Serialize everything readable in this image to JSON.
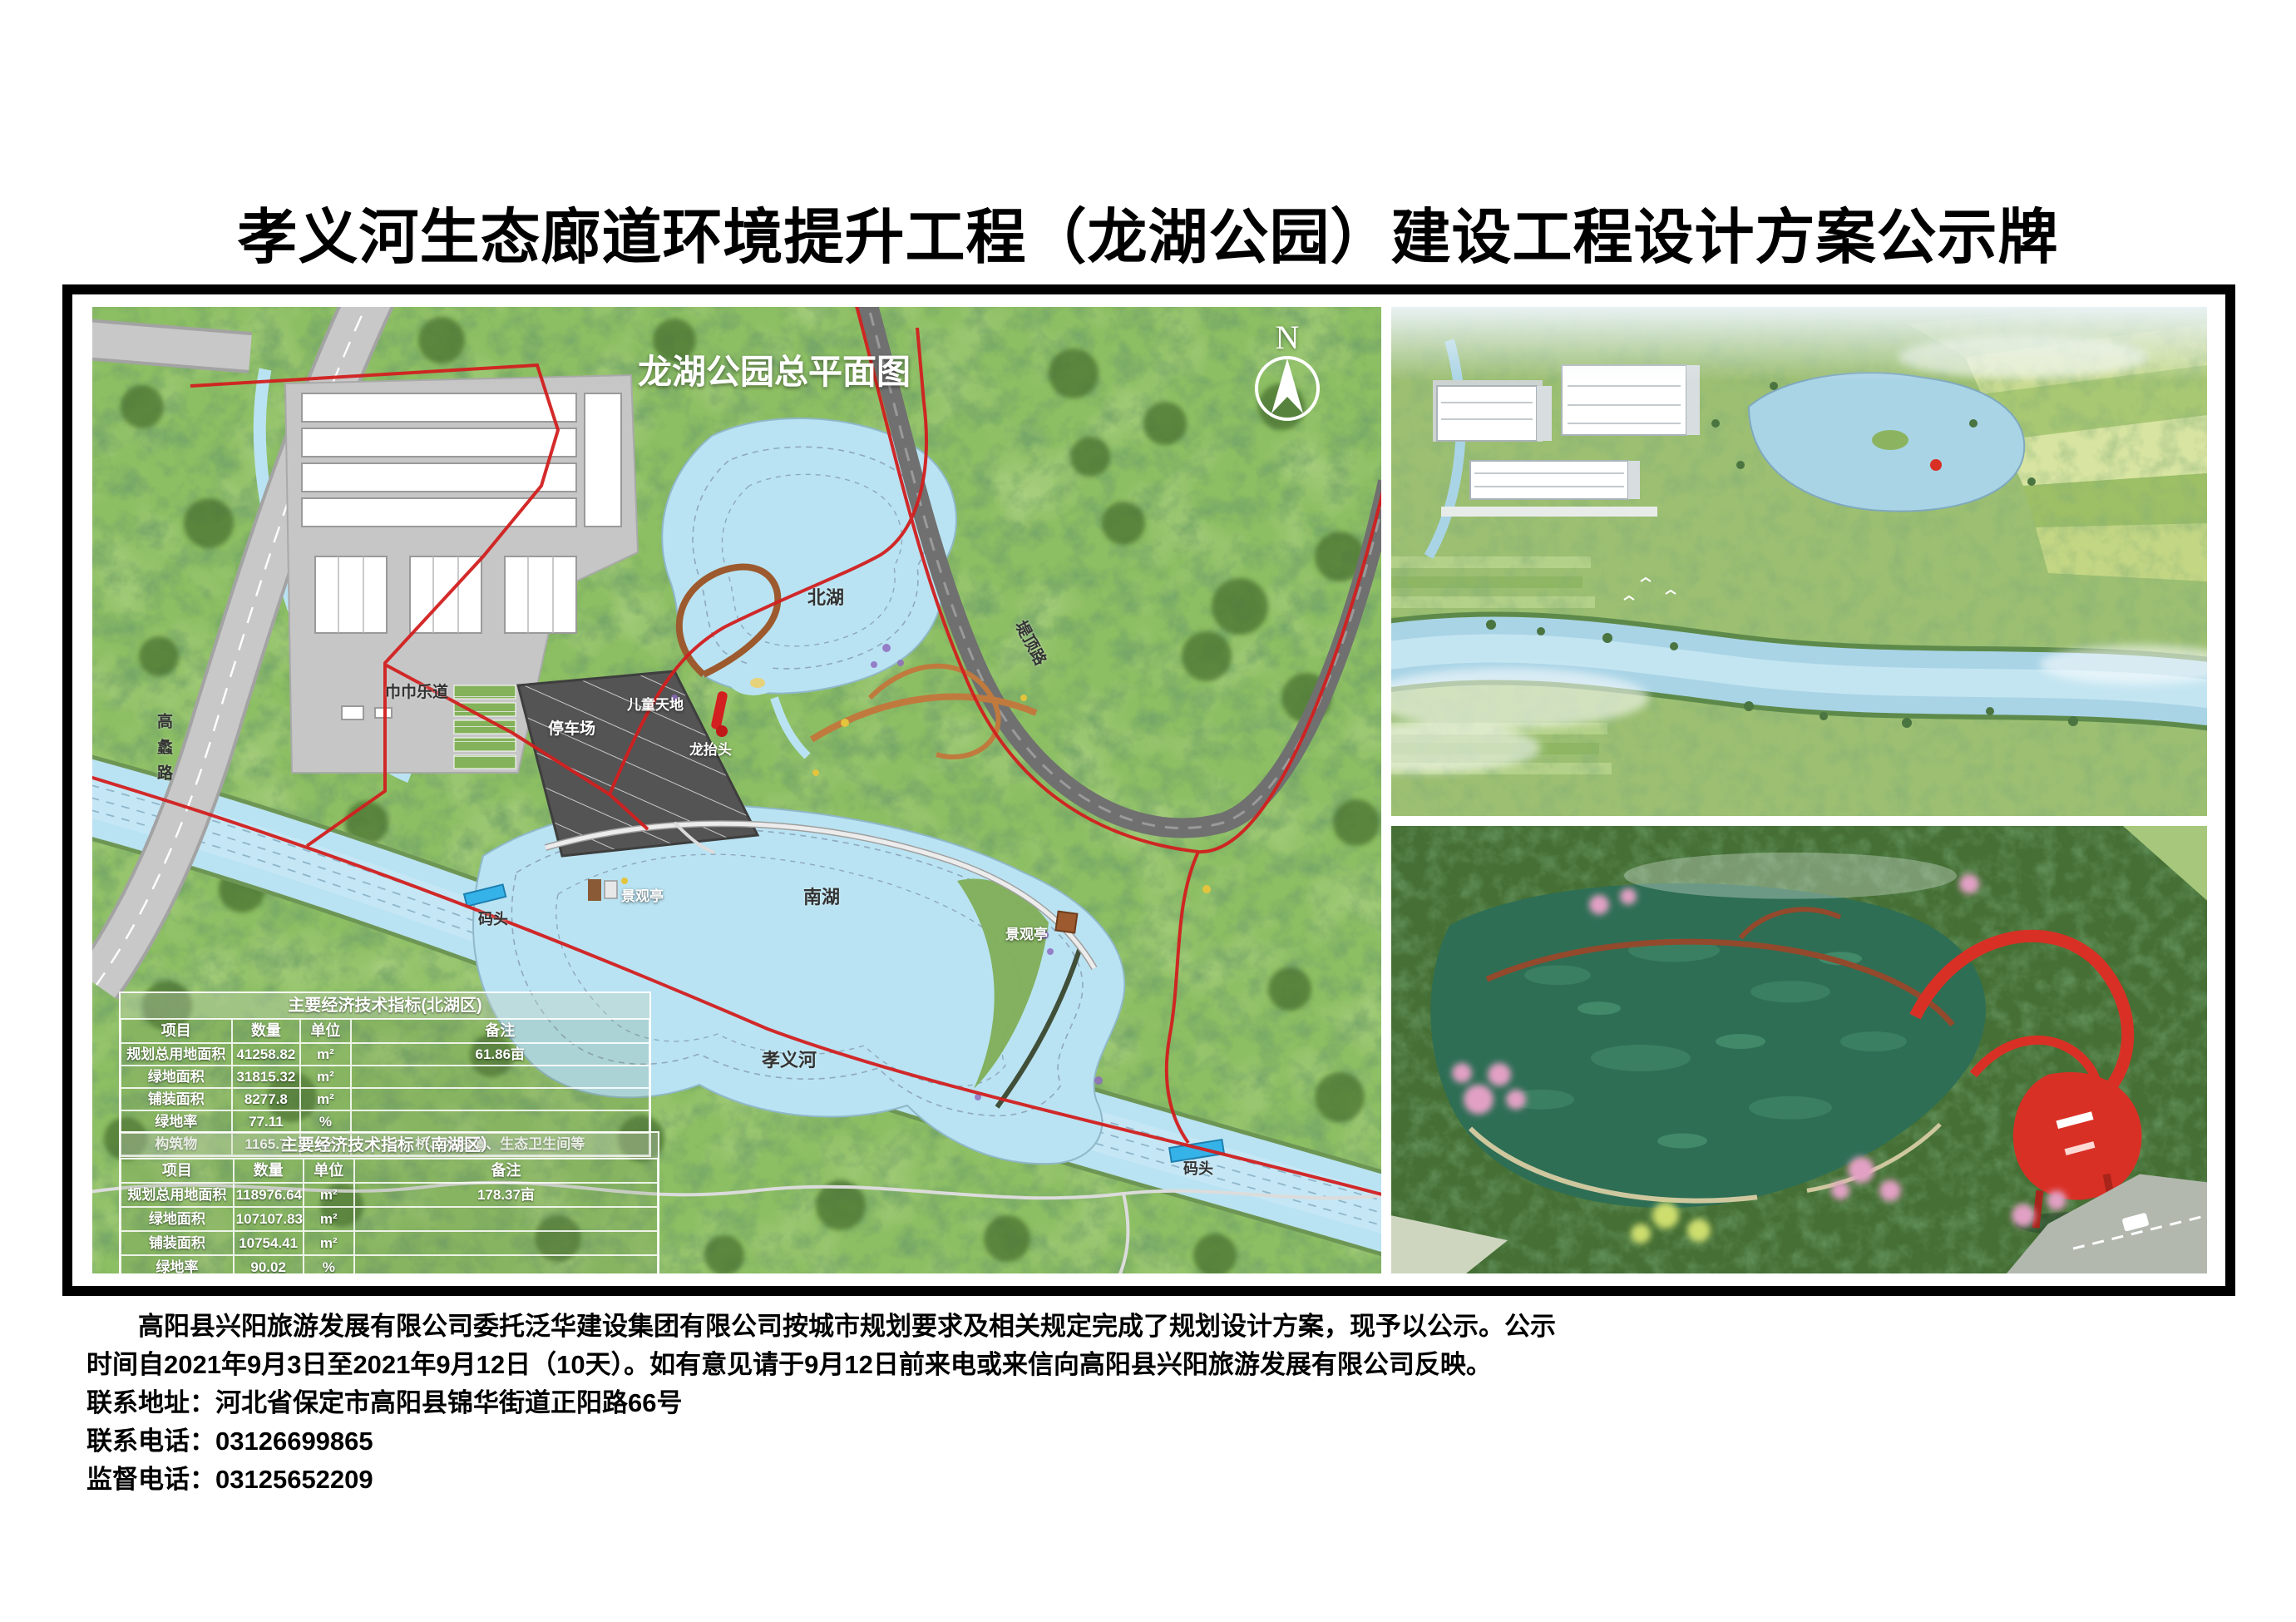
{
  "page_title": "孝义河生态廊道环境提升工程（龙湖公园）建设工程设计方案公示牌",
  "map": {
    "title": "龙湖公园总平面图",
    "north_label": "N",
    "labels": {
      "north_lake": "北湖",
      "south_lake": "南湖",
      "river": "孝义河",
      "gaoli_road": "高蠡路",
      "diding_road": "堤顶路",
      "parking_lot": "停车场",
      "children_world": "儿童天地",
      "dragon_head": "龙抬头",
      "jinjin_trail": "巾巾乐道",
      "pavilion_west": "景观亭",
      "pavilion_east": "景观亭",
      "dock_west": "码头",
      "dock_east": "码头"
    }
  },
  "tables": [
    {
      "title": "主要经济技术指标(北湖区)",
      "headers": [
        "项目",
        "数量",
        "单位",
        "备注"
      ],
      "rows": [
        [
          "规划总用地面积",
          "41258.82",
          "m²",
          "61.86亩"
        ],
        [
          "绿地面积",
          "31815.32",
          "m²",
          ""
        ],
        [
          "铺装面积",
          "8277.8",
          "m²",
          ""
        ],
        [
          "绿地率",
          "77.11",
          "%",
          ""
        ],
        [
          "构筑物",
          "1165.7",
          "m²",
          "桥、木栈道、生态卫生间等"
        ]
      ]
    },
    {
      "title": "主要经济技术指标（南湖区）",
      "headers": [
        "项目",
        "数量",
        "单位",
        "备注"
      ],
      "rows": [
        [
          "规划总用地面积",
          "118976.64",
          "m²",
          "178.37亩"
        ],
        [
          "绿地面积",
          "107107.83",
          "m²",
          ""
        ],
        [
          "铺装面积",
          "10754.41",
          "m²",
          ""
        ],
        [
          "绿地率",
          "90.02",
          "%",
          ""
        ],
        [
          "构筑物",
          "1114.4",
          "m²",
          "景观桥、木栈道等"
        ]
      ]
    }
  ],
  "notice": {
    "line1": "高阳县兴阳旅游发展有限公司委托泛华建设集团有限公司按城市规划要求及相关规定完成了规划设计方案，现予以公示。公示",
    "line2": "时间自2021年9月3日至2021年9月12日（10天）。如有意见请于9月12日前来电或来信向高阳县兴阳旅游发展有限公司反映。",
    "address": "联系地址：河北省保定市高阳县锦华街道正阳路66号",
    "phone": "联系电话：03126699865",
    "supervision_phone": "监督电话：03125652209"
  },
  "colors": {
    "boundary_red": "#d21f1f",
    "water_blue": "#b9e3f2",
    "dock_blue": "#35b3e8",
    "structure_red": "#d93025",
    "map_green": "#8cbe63"
  }
}
